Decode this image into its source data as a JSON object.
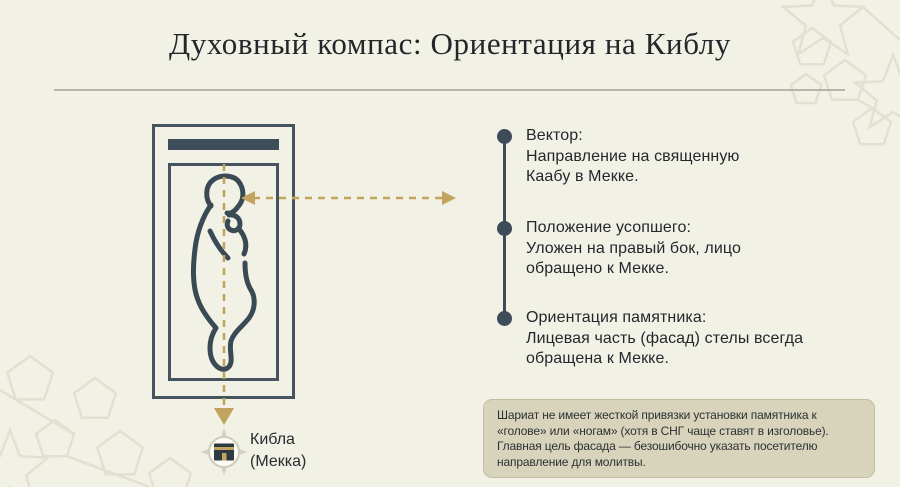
{
  "slide": {
    "title": "Духовный компас: Ориентация на Киблу"
  },
  "diagram": {
    "qibla_label": {
      "line1": "Кибла",
      "line2": "(Мекка)"
    },
    "icons": {
      "kaaba_compass": "kaaba-compass-icon",
      "double_arrow": "qibla-direction-double-arrow",
      "down_arrow": "qibla-down-arrow"
    }
  },
  "points": {
    "items": [
      {
        "heading": "Вектор:",
        "line1": "Направление на священную",
        "line2": "Каабу в Мекке."
      },
      {
        "heading": "Положение усопшего:",
        "line1": "Уложен на правый бок, лицо",
        "line2": "обращено к Мекке."
      },
      {
        "heading": "Ориентация памятника:",
        "line1": "Лицевая часть (фасад) стелы всегда",
        "line2": "обращена к Мекке."
      }
    ]
  },
  "note": {
    "lines": [
      "Шариат не имеет жесткой привязки установки памятника к",
      "«голове» или «ногам» (хотя в СНГ чаще ставят в изголовье).",
      "Главная цель фасада — безошибочно указать посетителю",
      "направление для молитвы."
    ]
  },
  "colors": {
    "background": "#f2f1e6",
    "slate": "#3d4c58",
    "gold": "#c2a45f",
    "note_background": "#d8d4bc",
    "text": "#23282c"
  }
}
